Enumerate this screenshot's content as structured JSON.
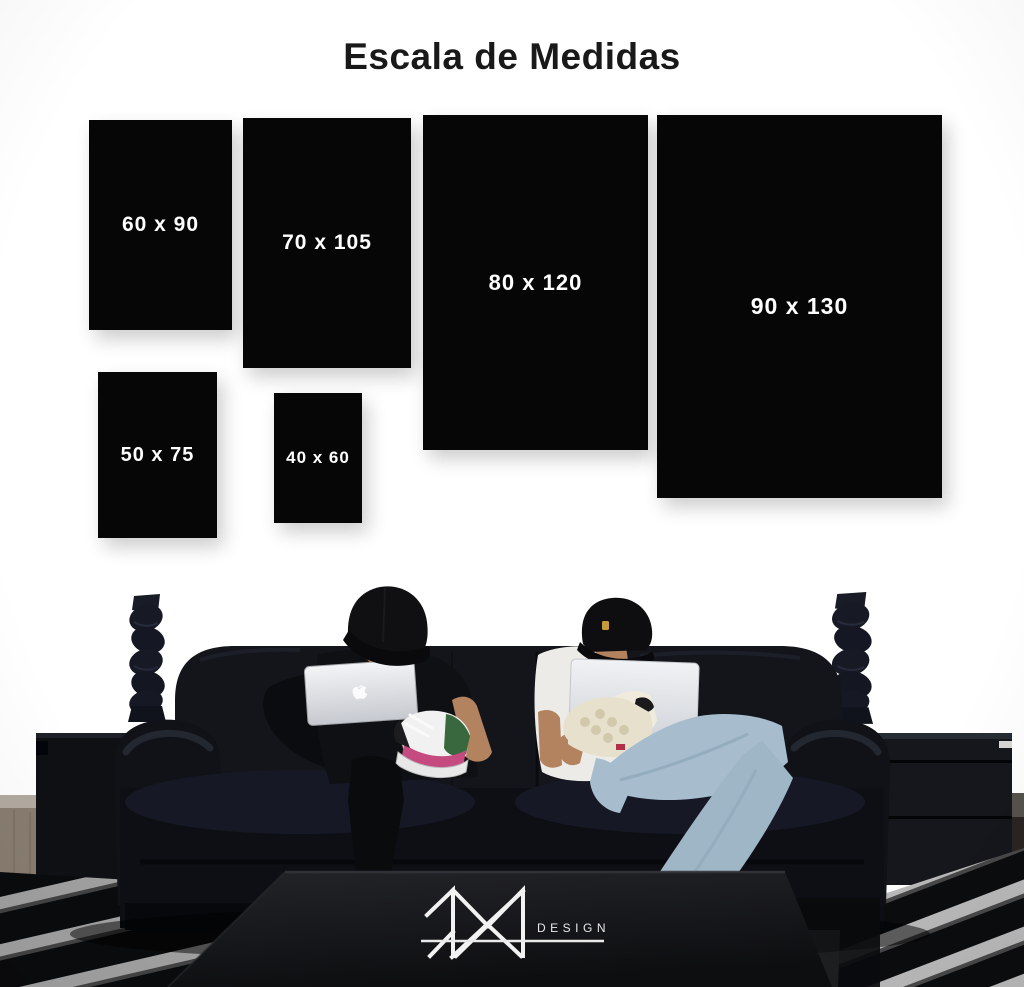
{
  "page": {
    "title": "Escala de Medidas",
    "background_color": "#ffffff"
  },
  "size_chart": {
    "box_color": "#060607",
    "label_color": "#ffffff",
    "items": [
      {
        "label": "60 x 90",
        "width_cm": 60,
        "height_cm": 90
      },
      {
        "label": "70 x 105",
        "width_cm": 70,
        "height_cm": 105
      },
      {
        "label": "80 x 120",
        "width_cm": 80,
        "height_cm": 120
      },
      {
        "label": "90 x 130",
        "width_cm": 90,
        "height_cm": 130
      },
      {
        "label": "50 x 75",
        "width_cm": 50,
        "height_cm": 75
      },
      {
        "label": "40 x 60",
        "width_cm": 40,
        "height_cm": 60
      }
    ]
  },
  "brand": {
    "monogram_icon": "mr-monogram-icon",
    "logo_text": "DESIGN",
    "logo_color": "#f2f2f2"
  },
  "scene": {
    "description": "Two men in black caps sit on a black leather sofa using Apple laptops, flanked by twisted black candlestick sculptures on dark sideboards, with a black-and-white striped shag rug and a dark coffee table in the foreground.",
    "icons": [
      "apple-logo-icon",
      "mr-monogram-icon"
    ],
    "colors": {
      "couch": "#11131a",
      "laptop": "#e9ebee",
      "jeans": "#a7bdcd",
      "tshirt_right": "#edecea",
      "rug_stripe": "#c3c3c3",
      "floor_left": "#897d71",
      "table": "#17181b"
    }
  }
}
